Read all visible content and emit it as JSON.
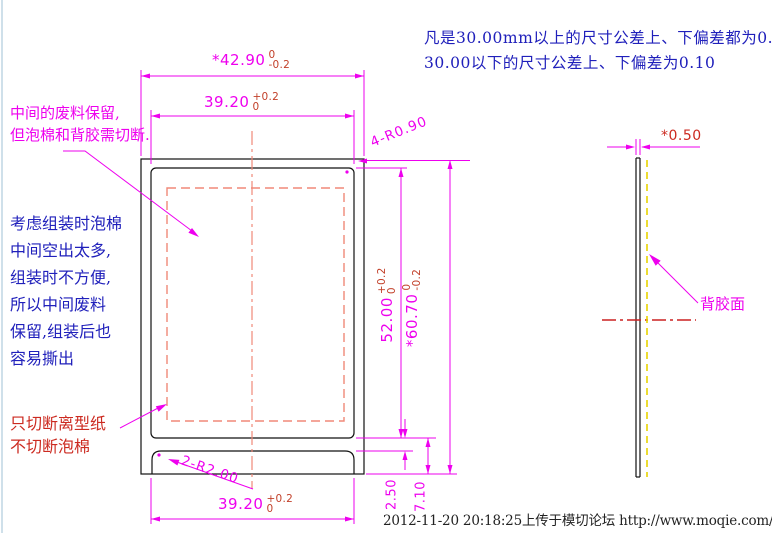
{
  "notes": {
    "tolerance_line1": "凡是30.00mm以上的尺寸公差上、下偏差都为0.15",
    "tolerance_line2": "30.00以下的尺寸公差上、下偏差为0.10"
  },
  "annotations": {
    "keep_waste": {
      "line1": "中间的废料保留,",
      "line2": "但泡棉和背胶需切断."
    },
    "assembly": {
      "lines": [
        "考虑组装时泡棉",
        "中间空出太多,",
        "组装时不方便,",
        "所以中间废料",
        "保留,组装后也",
        "容易撕出"
      ]
    },
    "cut_liner": {
      "line1": "只切断离型纸",
      "line2": "不切断泡棉"
    },
    "adhesive_face": "背胶面"
  },
  "dimensions": {
    "outer_width": {
      "value": "*42.90",
      "tol_top": "0",
      "tol_bottom": "-0.2"
    },
    "inner_width": {
      "value": "39.20",
      "tol_top": "+0.2",
      "tol_bottom": "0"
    },
    "inner_height": {
      "value": "52.00",
      "tol_top": "+0.2",
      "tol_bottom": "0"
    },
    "outer_height": {
      "value": "*60.70",
      "tol_top": "0",
      "tol_bottom": "-0.2"
    },
    "tab_width": {
      "value": "39.20",
      "tol_top": "+0.2",
      "tol_bottom": "0"
    },
    "corner_radius_part": "4-R0.90",
    "corner_radius_tab": "2-R2.00",
    "gap_part_tab": "2.50",
    "part_to_sheet_bottom": "7.10",
    "thickness": "*0.50"
  },
  "footer": {
    "upload_info": "2012-11-20 20:18:25上传于模切论坛 http://www.moqie.com/bbs/"
  },
  "colors": {
    "dimension_magenta": "#ee00ee",
    "tolerance_red": "#c2402a",
    "note_blue": "#2020bb",
    "warning_red": "#cc2a20",
    "waste_dashed_salmon": "#f08878",
    "centerline_red": "#cc2020",
    "adhesive_yellow": "#e8d400",
    "outline_black": "#111111"
  }
}
